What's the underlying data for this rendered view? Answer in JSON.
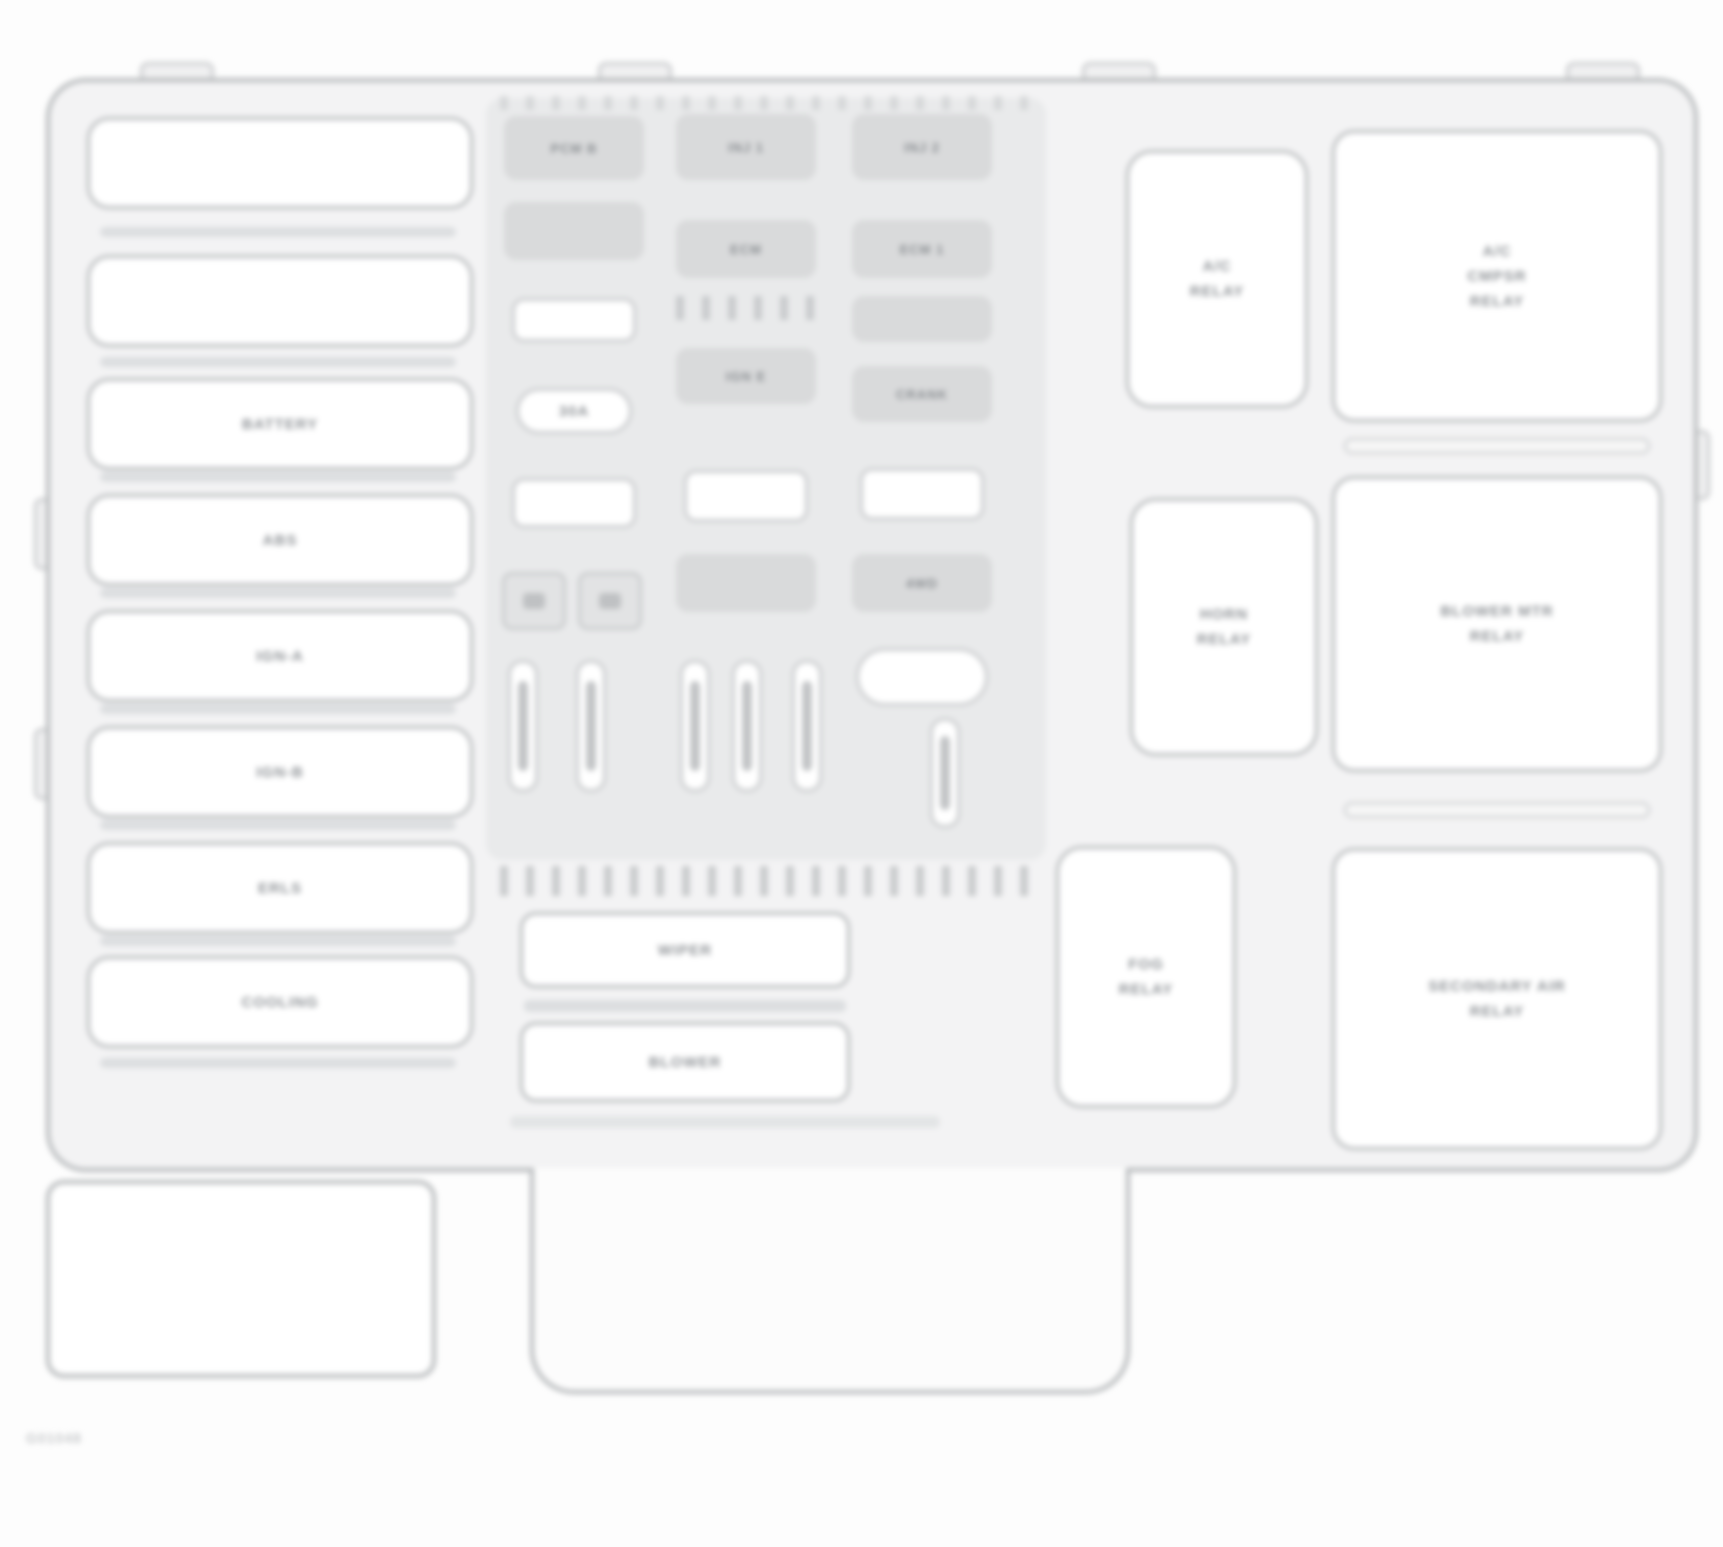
{
  "figure_code": "G01048",
  "left_bank": {
    "labels": [
      "",
      "",
      "BATTERY",
      "ABS",
      "IGN-A",
      "IGN-B",
      "ERLS",
      "COOLING"
    ]
  },
  "columns": [
    {
      "fuses": [
        "PCM B",
        "",
        "30A"
      ]
    },
    {
      "fuses": [
        "INJ 1",
        "ECM",
        "IGN E",
        ""
      ]
    },
    {
      "fuses": [
        "INJ 2",
        "ECM 1",
        "",
        "CRANK",
        "4WD",
        ""
      ]
    }
  ],
  "wide_slots": {
    "a": "WIPER",
    "b": "BLOWER"
  },
  "relays": [
    {
      "lines": [
        "A/C",
        "RELAY"
      ]
    },
    {
      "lines": [
        "HORN",
        "RELAY"
      ]
    },
    {
      "lines": [
        "FOG",
        "RELAY"
      ]
    }
  ],
  "right_boxes": [
    {
      "lines": [
        "A/C",
        "CMPSR",
        "RELAY"
      ]
    },
    {
      "lines": [
        "BLOWER MTR",
        "RELAY"
      ]
    },
    {
      "lines": [
        "SECONDARY AIR",
        "RELAY"
      ]
    }
  ],
  "colors": {
    "line": "#b6b9bb",
    "line_soft": "#c9cbcd",
    "text": "#8f9397",
    "fuse_fill": "#d9dadb",
    "panel": "#e9eaeb",
    "board": "#f3f3f4",
    "background": "#fdfdfd"
  }
}
